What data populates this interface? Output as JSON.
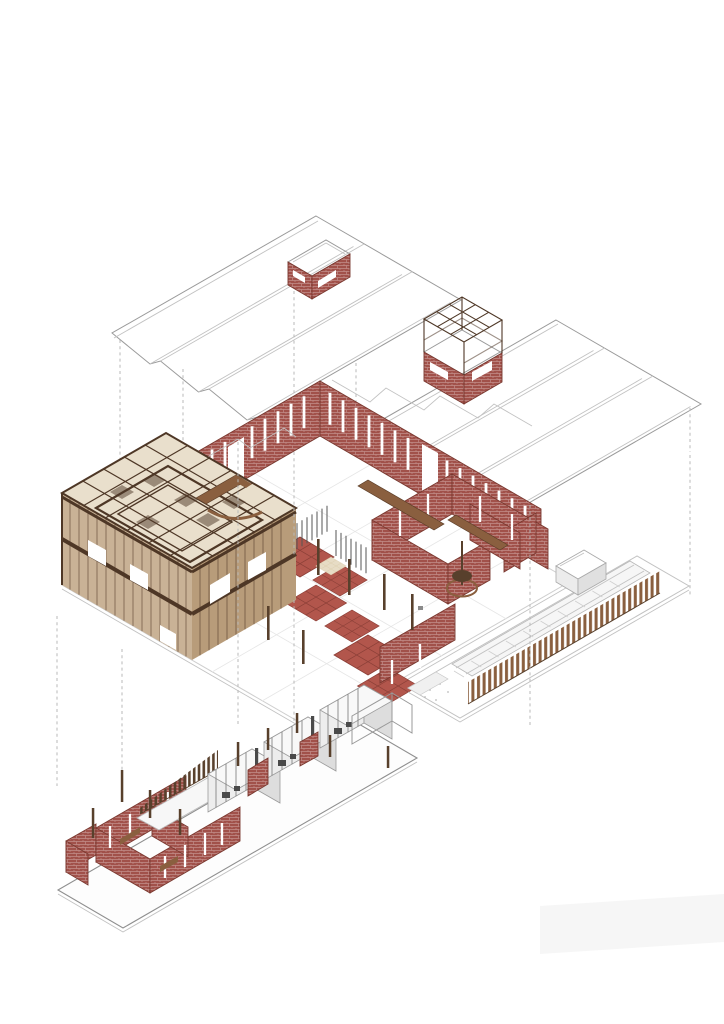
{
  "scene": {
    "type": "exploded axonometric architectural drawing",
    "levels": [
      {
        "id": "roof-level",
        "elements": [
          "sawtooth-roof-north",
          "sawtooth-roof-south",
          "brick-roof-vent",
          "brick-roof-pavilion-with-timber-lattice"
        ]
      },
      {
        "id": "main-floor-level",
        "elements": [
          "floor-slab",
          "perimeter-brick-walls-with-window-slits",
          "timber-mezzanine-structure",
          "interior-brick-room-cluster",
          "bar-counters",
          "spiral-stair",
          "red-tile-floor-patches",
          "terrace-platform",
          "linear-track-strip",
          "kiosk-box",
          "picket-fence-row"
        ]
      },
      {
        "id": "lower-level",
        "elements": [
          "strip-slab",
          "brick-rooms",
          "service-unit-boxes",
          "ramp-picket-fence",
          "timber-posts"
        ]
      }
    ],
    "projection_lines": "dashed-vertical-guides"
  },
  "colors": {
    "paper": "#ffffff",
    "line": "#9a9a9a",
    "line_light": "#c2c2c2",
    "floor_grid": "#e6e6e6",
    "dash_line": "#b8b8b8",
    "brick": "#a1514a",
    "brick_dark": "#79382f",
    "wood": "#8a5f3f",
    "wood_dark": "#58402c",
    "timber_frame": "#4e3726",
    "timber_face": "#c9b296",
    "timber_face2": "#b89c7a",
    "deck": "#e9dfcc",
    "tile": "#b2564c",
    "tile_line": "#8c4038",
    "tan": "#e7dcc5",
    "panel": "#ededed",
    "panel_side": "#dddddd",
    "panel_top": "#f8f8f8",
    "panel_line": "#9b9b9b",
    "stud": "#4a4a4a",
    "shadow": "#f2f2f2"
  }
}
